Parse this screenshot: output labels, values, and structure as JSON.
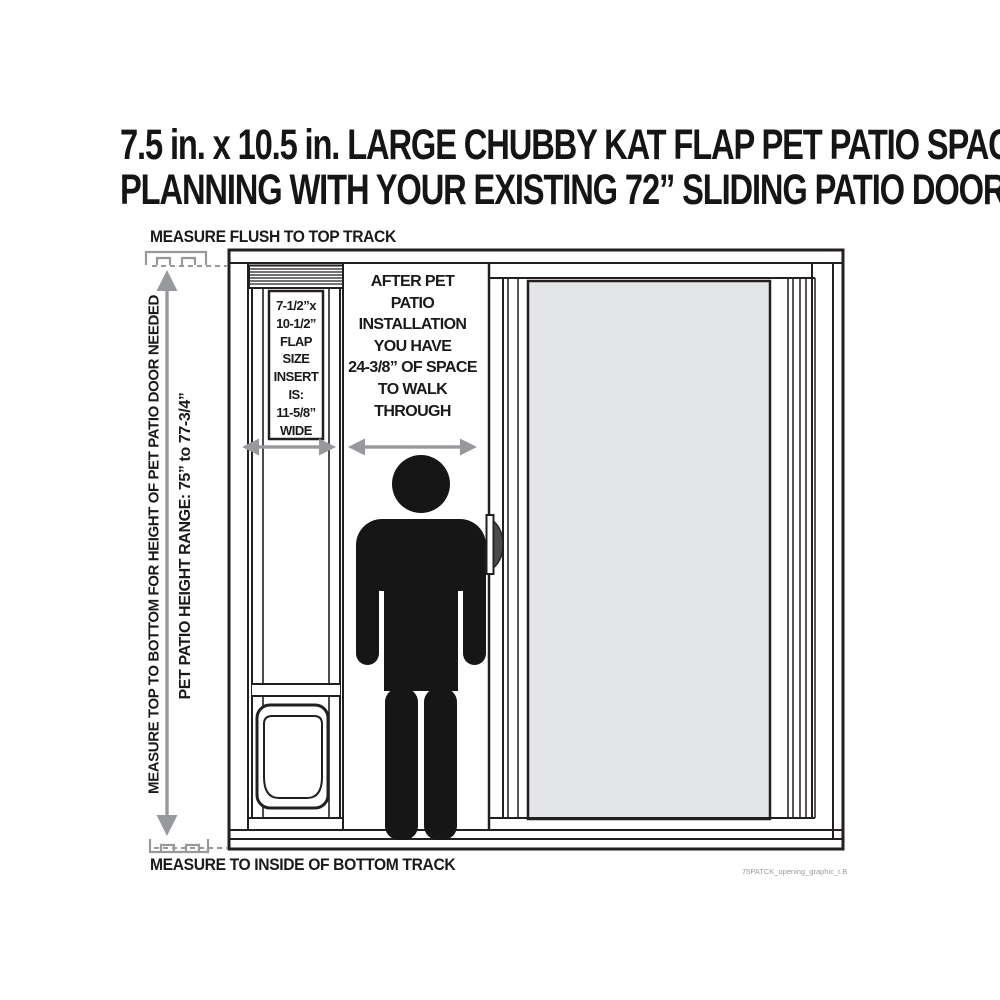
{
  "title": {
    "line1": "7.5 in. x 10.5 in. LARGE CHUBBY KAT FLAP PET PATIO SPACE",
    "line2": "PLANNING WITH YOUR EXISTING 72” SLIDING PATIO DOOR"
  },
  "labels": {
    "measure_top": "MEASURE FLUSH TO TOP TRACK",
    "measure_bottom": "MEASURE TO INSIDE OF BOTTOM TRACK",
    "height_needed": "MEASURE TOP TO BOTTOM FOR HEIGHT OF PET PATIO DOOR NEEDED",
    "height_range": "PET PATIO HEIGHT RANGE: 75” to 77-3/4”",
    "watermark": "75PATCK_opening_graphic_r.B"
  },
  "flap_panel": {
    "lines": [
      "7-1/2”x",
      "10-1/2”",
      "FLAP",
      "SIZE",
      "INSERT",
      "IS:",
      "11-5/8”",
      "WIDE"
    ]
  },
  "walkthrough": {
    "lines": [
      "AFTER PET",
      "PATIO",
      "INSTALLATION",
      "YOU HAVE",
      "24-3/8” OF SPACE",
      "TO WALK",
      "THROUGH"
    ]
  },
  "colors": {
    "line": "#231f20",
    "arrow_gray": "#97999c",
    "glass": "#e4e5e7",
    "figure": "#161616",
    "background": "#ffffff"
  }
}
